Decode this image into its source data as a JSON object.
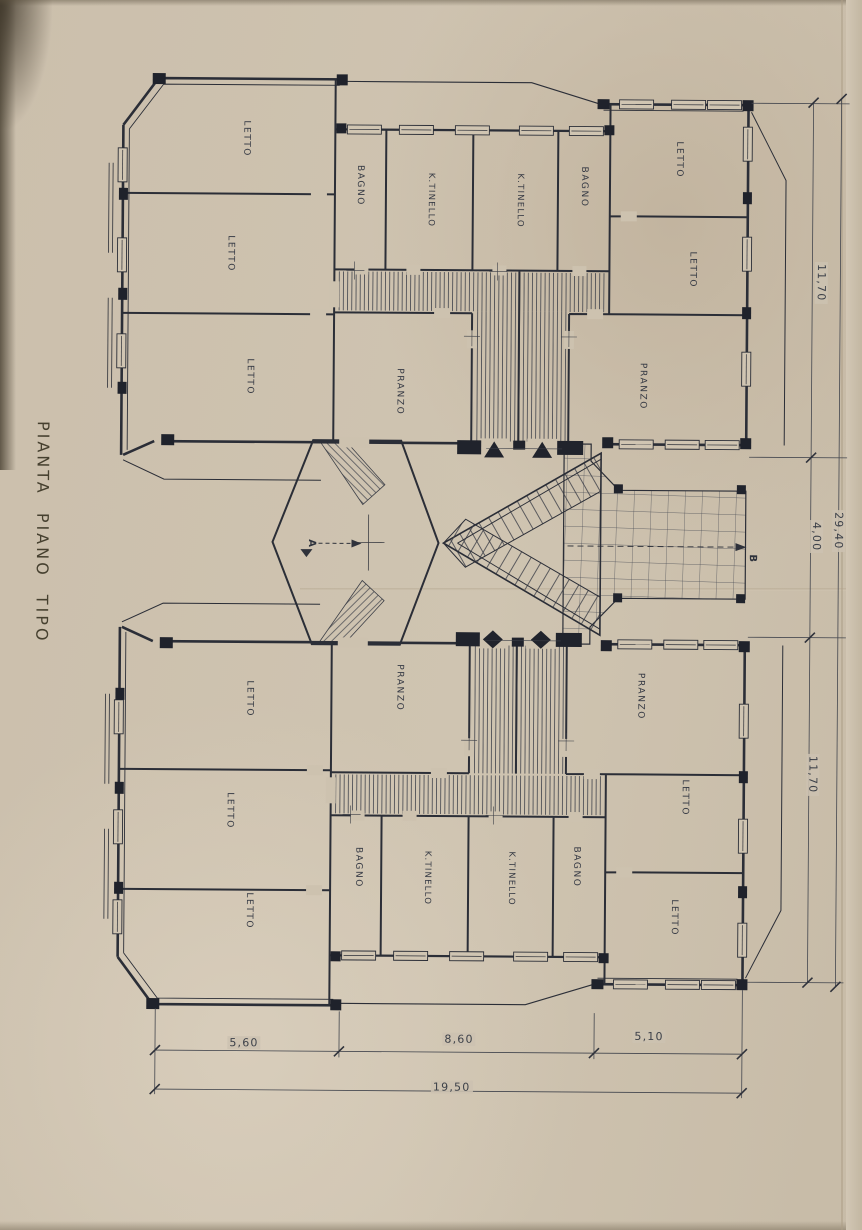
{
  "title": "PIANTA PIANO TIPO",
  "rooms": [
    {
      "label": "LETTO"
    },
    {
      "label": "LETTO"
    },
    {
      "label": "LETTO"
    },
    {
      "label": "BAGNO"
    },
    {
      "label": "K.TINELLO"
    },
    {
      "label": "K.TINELLO"
    },
    {
      "label": "BAGNO"
    },
    {
      "label": "LETTO"
    },
    {
      "label": "LETTO"
    },
    {
      "label": "PRANZO"
    },
    {
      "label": "PRANZO"
    },
    {
      "label": "PRANZO"
    },
    {
      "label": "PRANZO"
    },
    {
      "label": "LETTO"
    },
    {
      "label": "LETTO"
    },
    {
      "label": "LETTO"
    },
    {
      "label": "BAGNO"
    },
    {
      "label": "K.TINELLO"
    },
    {
      "label": "K.TINELLO"
    },
    {
      "label": "BAGNO"
    },
    {
      "label": "LETTO"
    },
    {
      "label": "LETTO"
    }
  ],
  "markers": {
    "stair": "A",
    "terrace": "B"
  },
  "dimensions": {
    "right_side": [
      "11,70",
      "4,00",
      "29,40",
      "11,70"
    ],
    "bottom": [
      "5,60",
      "8,60",
      "5,10",
      "19,50"
    ]
  }
}
